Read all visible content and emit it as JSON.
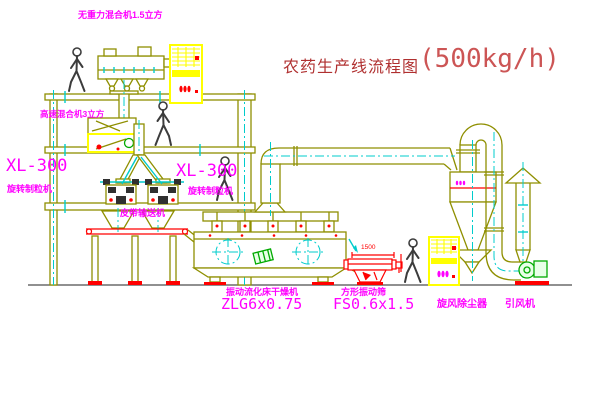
{
  "title": {
    "name": "农药生产线流程图",
    "capacity": "(500kg/h)"
  },
  "labels": {
    "top_mixer": "无重力混合机1.5立方",
    "high_speed_mixer": "高速混合机3立方",
    "granulator_left_model": "XL-300",
    "granulator_left_name": "旋转制粒机",
    "granulator_right_model": "XL-300",
    "granulator_right_name": "旋转制粒机",
    "belt_conveyor": "皮带输送机",
    "dryer_name": "振动流化床干燥机",
    "dryer_model": "ZLG6x0.75",
    "sieve_name": "方形振动筛",
    "sieve_model": "FS0.6x1.5",
    "sieve_dimension": "1500",
    "cyclone": "旋风除尘器",
    "fan": "引风机"
  },
  "colors": {
    "outline": "#8f8f00",
    "highlight": "#ffff00",
    "centerline": "#00cccc",
    "accent": "#ff0000",
    "label": "#ff00ff",
    "title": "#b03030",
    "title2": "#cc5555",
    "green": "#00aa00"
  }
}
